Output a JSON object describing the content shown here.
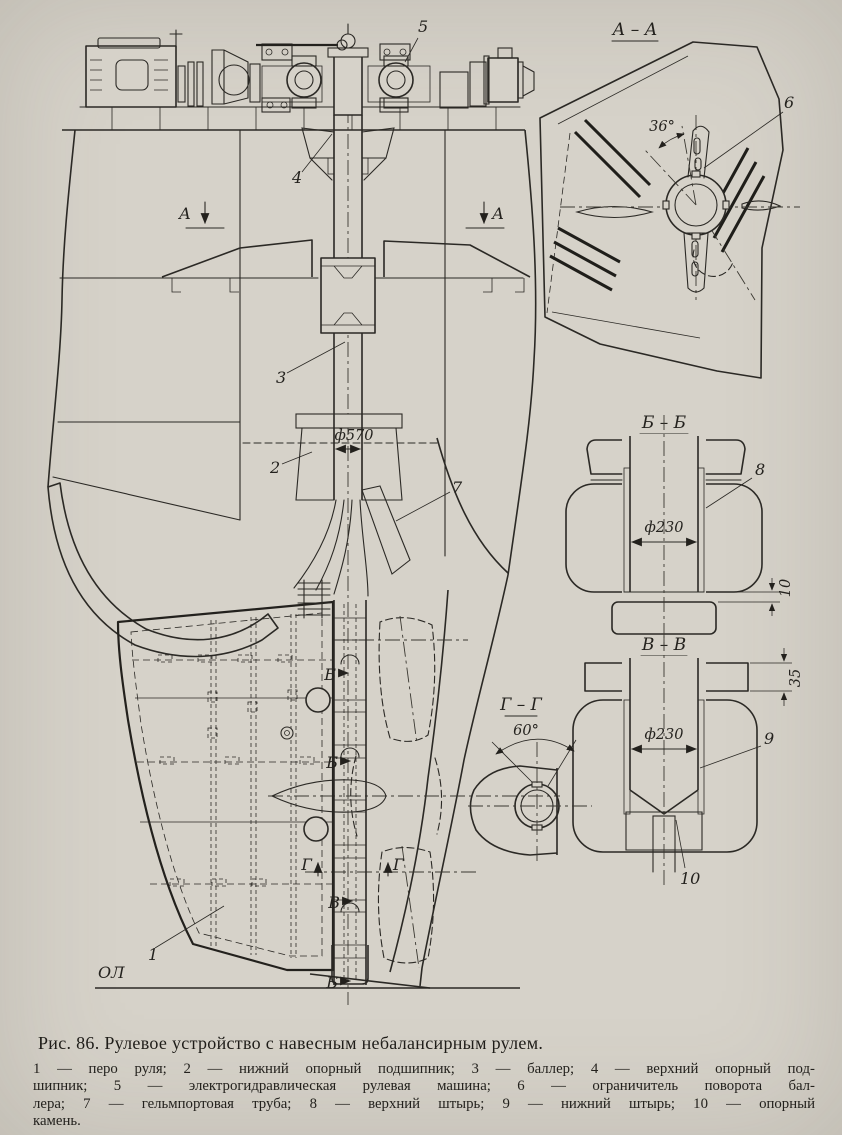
{
  "figure": {
    "caption": "Рис. 86. Рулевое устройство с навесным небалансирным рулем.",
    "legend_lines": [
      "1 — перо руля; 2 — нижний опорный подшипник; 3 — баллер; 4 — верхний опорный под-",
      "шипник; 5 — электрогидравлическая рулевая машина; 6 — ограничитель поворота бал-",
      "лера; 7 — гельмпортовая труба; 8 — верхний штырь; 9 — нижний штырь; 10 — опорный",
      "камень."
    ]
  },
  "main_view": {
    "dim_dia570": "ф570",
    "baseline": "ОЛ",
    "callout_1": "1",
    "callout_2": "2",
    "callout_3": "3",
    "callout_4": "4",
    "callout_5": "5",
    "callout_7": "7",
    "marker_a": "А",
    "marker_b": "Б",
    "marker_v": "В",
    "marker_g": "Г"
  },
  "section_aa": {
    "title": "А – А",
    "angle": "36°",
    "callout_6": "6"
  },
  "section_bb": {
    "title": "Б – Б",
    "dim_dia": "ф230",
    "callout_8": "8",
    "dim_gap": "10"
  },
  "section_vv": {
    "title": "В – В",
    "dim_dia": "ф230",
    "callout_9": "9",
    "callout_10": "10",
    "dim_depth": "35"
  },
  "section_gg": {
    "title": "Г – Г",
    "angle": "60°"
  },
  "colors": {
    "paper": "#d6d2c9",
    "ink": "#2b2925"
  }
}
